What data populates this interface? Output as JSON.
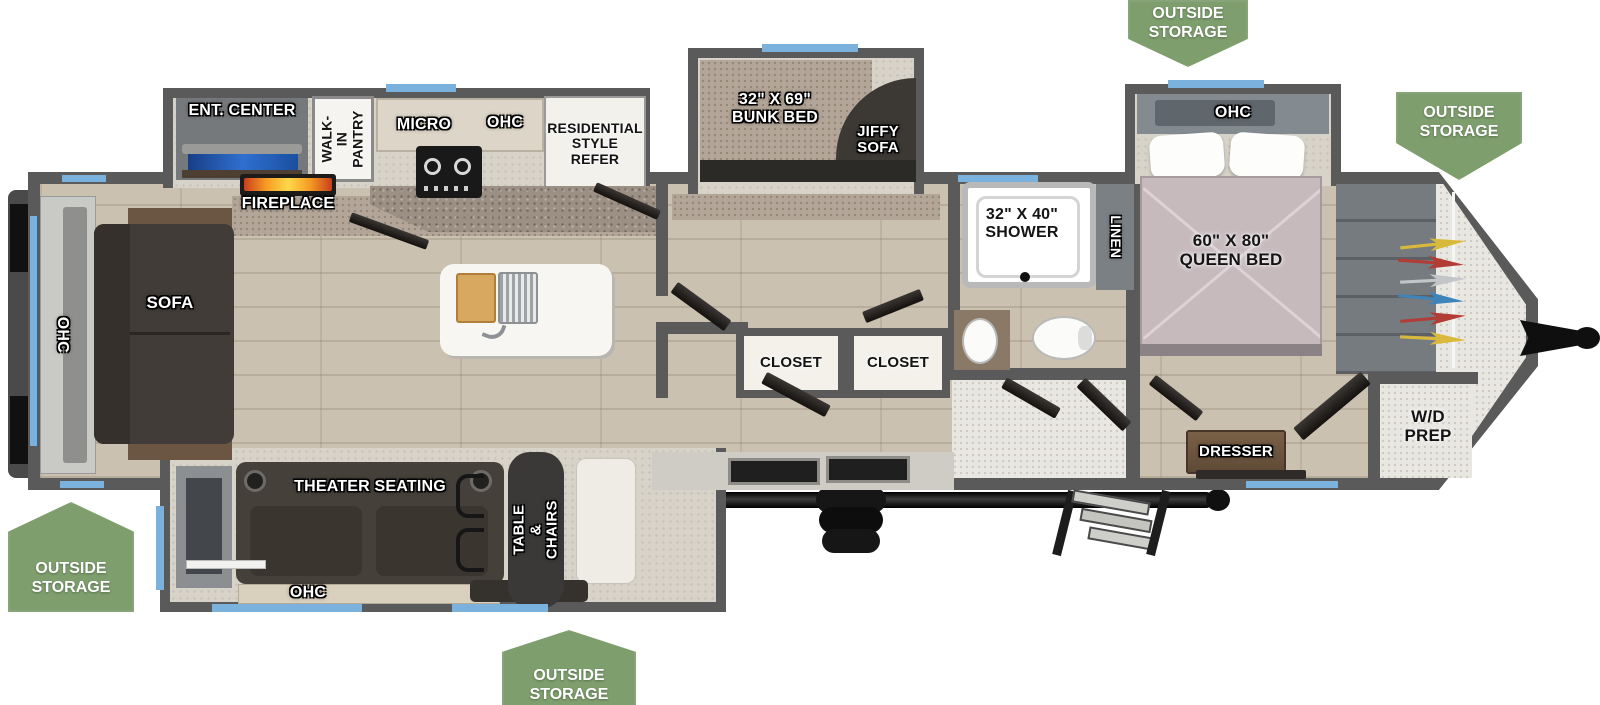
{
  "badges": {
    "top": {
      "label": "OUTSIDE\nSTORAGE"
    },
    "front_right": {
      "label": "OUTSIDE\nSTORAGE"
    },
    "rear_left": {
      "label": "OUTSIDE\nSTORAGE"
    },
    "bottom_center": {
      "label": "OUTSIDE\nSTORAGE"
    }
  },
  "labels": {
    "rear_ohc": "OHC",
    "sofa": "SOFA",
    "ent_center": "ENT. CENTER",
    "fireplace": "FIREPLACE",
    "walk_in_pantry": "WALK-IN\nPANTRY",
    "micro": "MICRO",
    "kitchen_ohc": "OHC",
    "refrigerator": "RESIDENTIAL\nSTYLE\nREFER",
    "bunk_bed": "32\" X 69\"\nBUNK BED",
    "jiffy_sofa": "JIFFY\nSOFA",
    "closet_left": "CLOSET",
    "closet_right": "CLOSET",
    "shower": "32\" X 40\"\nSHOWER",
    "linen": "LINEN",
    "bedroom_ohc": "OHC",
    "queen_bed": "60\" X 80\"\nQUEEN BED",
    "dresser": "DRESSER",
    "wd_prep": "W/D\nPREP",
    "theater_seating": "THEATER SEATING",
    "theater_ohc": "OHC",
    "table_chairs": "TABLE &\nCHAIRS"
  },
  "colors": {
    "badge_green": "#7e9e6e",
    "accent_blue": "#7ab2dd",
    "wall_gray": "#5a5a5a",
    "flame_orange": "#f59b23"
  }
}
